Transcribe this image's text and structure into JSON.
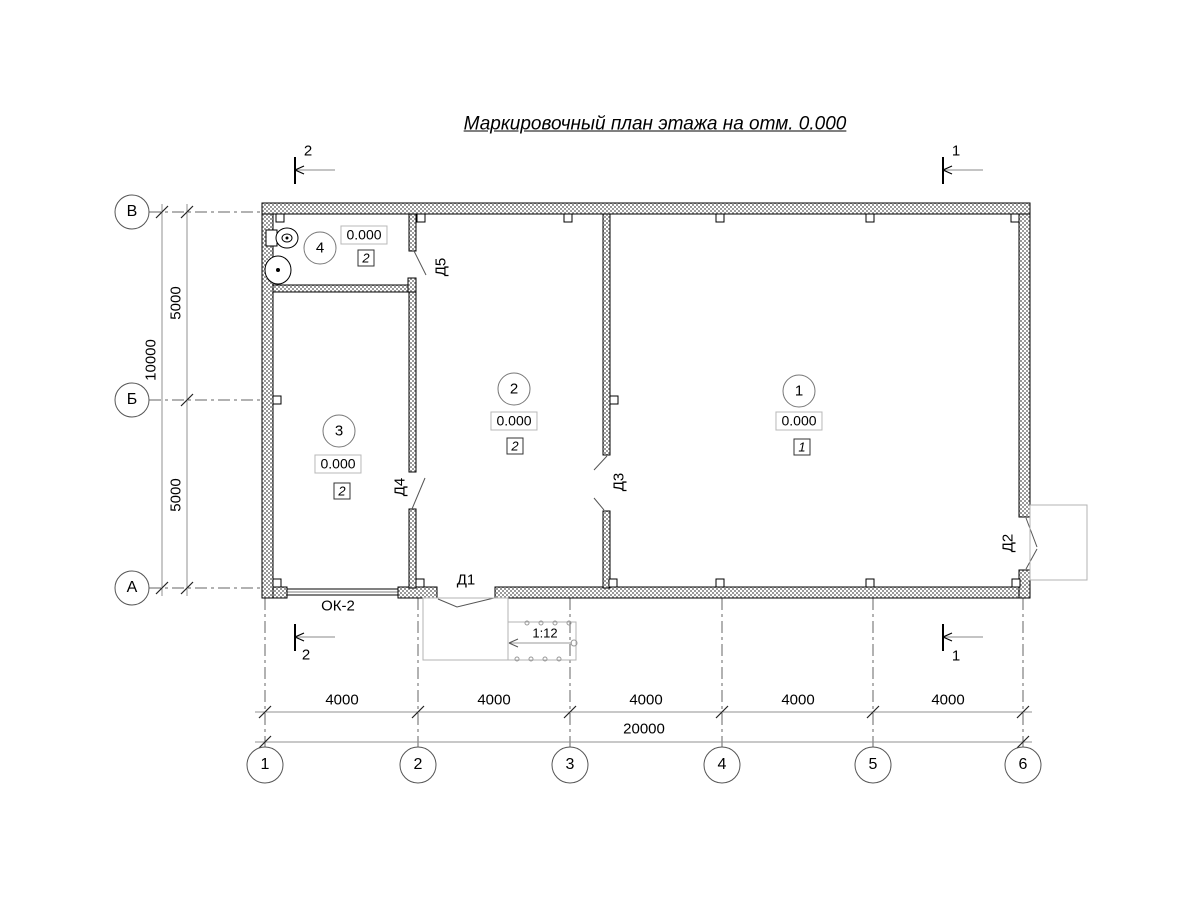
{
  "title": "Маркировочный план этажа на отм. 0.000",
  "axes": {
    "vertical": [
      {
        "label": "В"
      },
      {
        "label": "Б"
      },
      {
        "label": "А"
      }
    ],
    "horizontal": [
      {
        "label": "1"
      },
      {
        "label": "2"
      },
      {
        "label": "3"
      },
      {
        "label": "4"
      },
      {
        "label": "5"
      },
      {
        "label": "6"
      }
    ]
  },
  "dimensions": {
    "left_segments": [
      {
        "value": "5000"
      },
      {
        "value": "5000"
      }
    ],
    "left_total": "10000",
    "bottom_segments": [
      {
        "value": "4000"
      },
      {
        "value": "4000"
      },
      {
        "value": "4000"
      },
      {
        "value": "4000"
      },
      {
        "value": "4000"
      }
    ],
    "bottom_total": "20000"
  },
  "rooms": [
    {
      "number": "1",
      "elevation": "0.000",
      "finish_type": "1"
    },
    {
      "number": "2",
      "elevation": "0.000",
      "finish_type": "2"
    },
    {
      "number": "3",
      "elevation": "0.000",
      "finish_type": "2"
    },
    {
      "number": "4",
      "elevation": "0.000",
      "finish_type": "2"
    }
  ],
  "doors": [
    {
      "label": "Д1"
    },
    {
      "label": "Д2"
    },
    {
      "label": "Д3"
    },
    {
      "label": "Д4"
    },
    {
      "label": "Д5"
    }
  ],
  "window": {
    "label": "ОК-2"
  },
  "ramp": {
    "slope": "1:12"
  },
  "sections": {
    "top_left": "2",
    "top_right": "1",
    "bottom_left": "2",
    "bottom_right": "1"
  },
  "colors": {
    "line": "#000000",
    "dim_line": "#909090",
    "axis_line": "#666666",
    "porch_line": "#b3b3b3",
    "wall_hatch": "#9a9a9a"
  }
}
